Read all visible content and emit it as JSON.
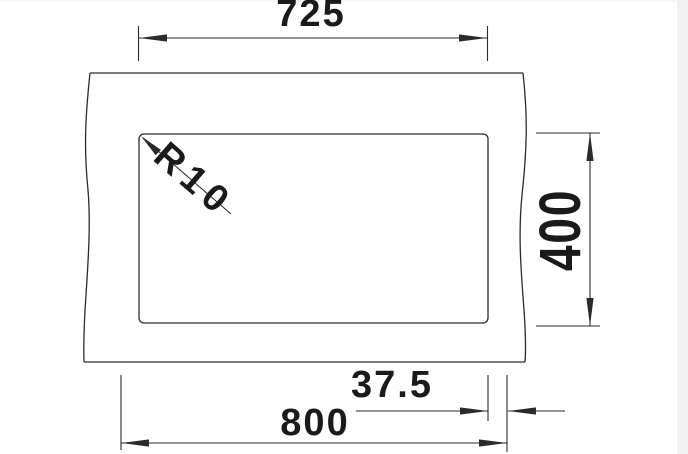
{
  "drawing": {
    "type": "technical-dimension-drawing",
    "labels": {
      "cutout_width": "725",
      "bowl_depth": "400",
      "overall_width": "800",
      "flange_offset": "37.5",
      "corner_radius": "R10"
    },
    "values": {
      "cutout_width_mm": 725,
      "bowl_depth_mm": 400,
      "overall_width_mm": 800,
      "flange_offset_mm": 37.5,
      "corner_radius_mm": 10
    },
    "colors": {
      "line": "#2b2b2b",
      "text": "#1a1a1a",
      "bg": "#ffffff",
      "strip": "#f1f1f1"
    }
  }
}
